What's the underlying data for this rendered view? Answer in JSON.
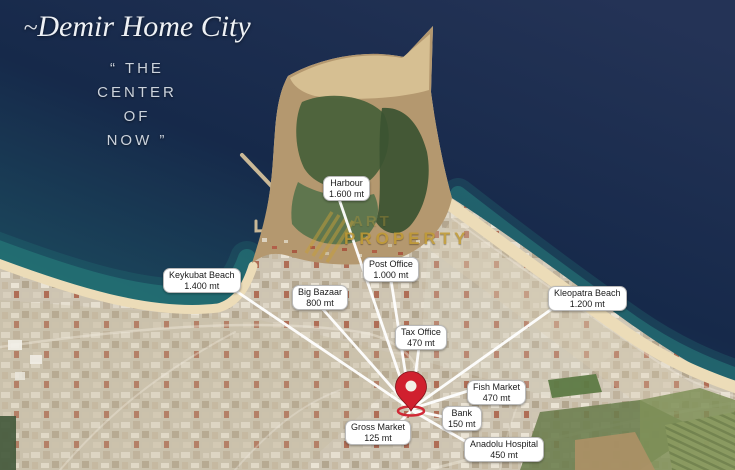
{
  "brand": {
    "swash": "~",
    "name": "Demir Home City",
    "tagline": [
      "“ THE",
      "CENTER",
      "OF",
      "NOW ”"
    ]
  },
  "watermark": {
    "ghost_text": "ART",
    "text": "PROPERTY"
  },
  "map": {
    "locations": [
      {
        "id": "harbour",
        "name": "Harbour",
        "distance": "1.600 mt"
      },
      {
        "id": "post-office",
        "name": "Post Office",
        "distance": "1.000 mt"
      },
      {
        "id": "keykubat-beach",
        "name": "Keykubat Beach",
        "distance": "1.400 mt"
      },
      {
        "id": "big-bazaar",
        "name": "Big Bazaar",
        "distance": "800 mt"
      },
      {
        "id": "kleopatra-beach",
        "name": "Kleopatra Beach",
        "distance": "1.200 mt"
      },
      {
        "id": "tax-office",
        "name": "Tax Office",
        "distance": "470 mt"
      },
      {
        "id": "fish-market",
        "name": "Fish Market",
        "distance": "470 mt"
      },
      {
        "id": "bank",
        "name": "Bank",
        "distance": "150 mt"
      },
      {
        "id": "gross-market",
        "name": "Gross Market",
        "distance": "125 mt"
      },
      {
        "id": "anadolu-hospital",
        "name": "Anadolu Hospital",
        "distance": "450 mt"
      }
    ]
  },
  "colors": {
    "sea_deep": "#16294a",
    "sea_light": "#243356",
    "bay_teal": "#1d5564",
    "shore_teal": "#2a8b84",
    "sand": "#ecdcb8",
    "city_base": "#cfc6b4",
    "forest_green": "#455f38",
    "pin_red": "#d0202e",
    "watermark_gold": "#c09a33",
    "label_bg": "#ffffff",
    "label_text": "#1b1b1b",
    "leader_line": "#ffffff"
  }
}
